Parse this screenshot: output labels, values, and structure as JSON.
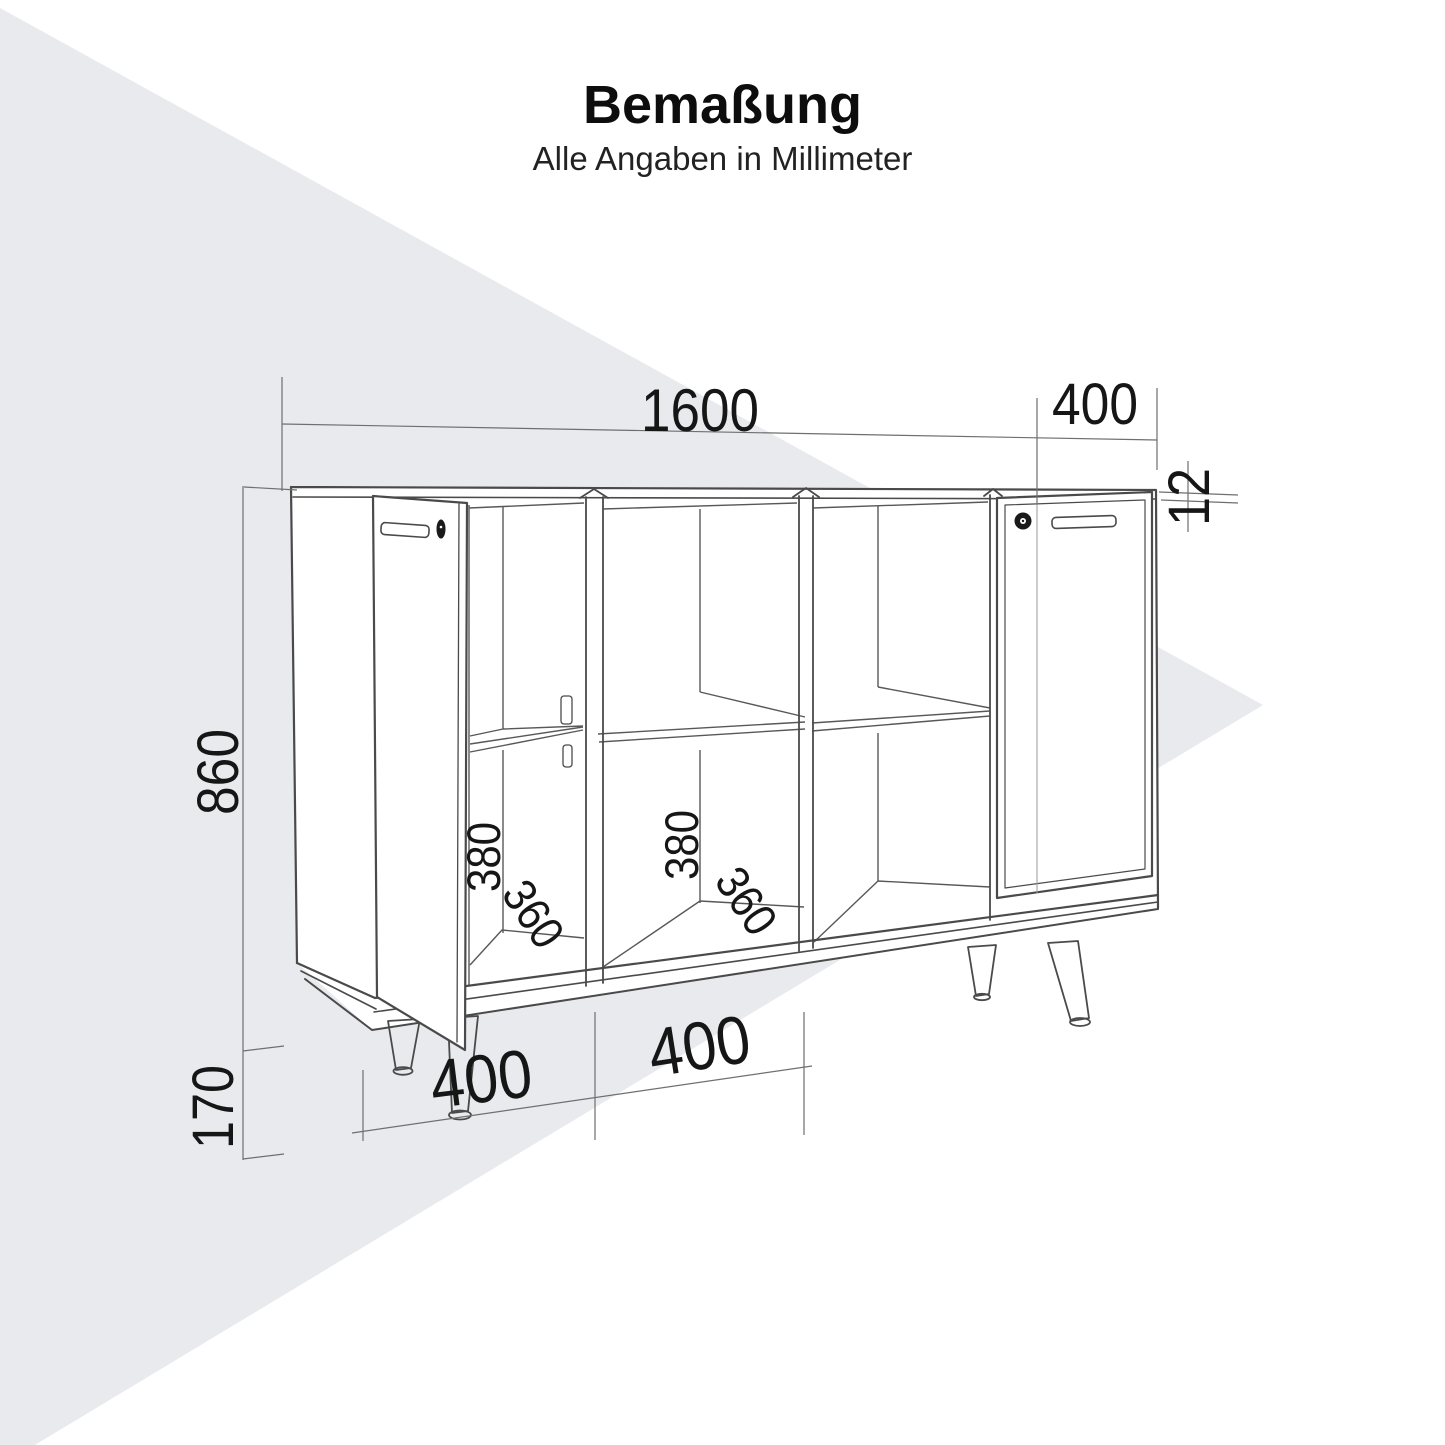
{
  "page": {
    "title": "Bemaßung",
    "subtitle": "Alle Angaben in Millimeter"
  },
  "colors": {
    "canvas": "#ffffff",
    "accent_triangle": "#e8eaee",
    "cabinet_line": "#4a4a4a",
    "dimension_line": "#6f6f6f",
    "label_color": "#161616"
  },
  "drawing": {
    "unit": "mm",
    "labels": {
      "total_width": "1600",
      "door_width": "400",
      "top_thickness": "12",
      "body_height": "860",
      "leg_height": "170",
      "left_inner_height": "380",
      "left_inner_width": "360",
      "mid_inner_height": "380",
      "mid_inner_width": "360",
      "segment_left": "400",
      "segment_mid": "400"
    }
  }
}
